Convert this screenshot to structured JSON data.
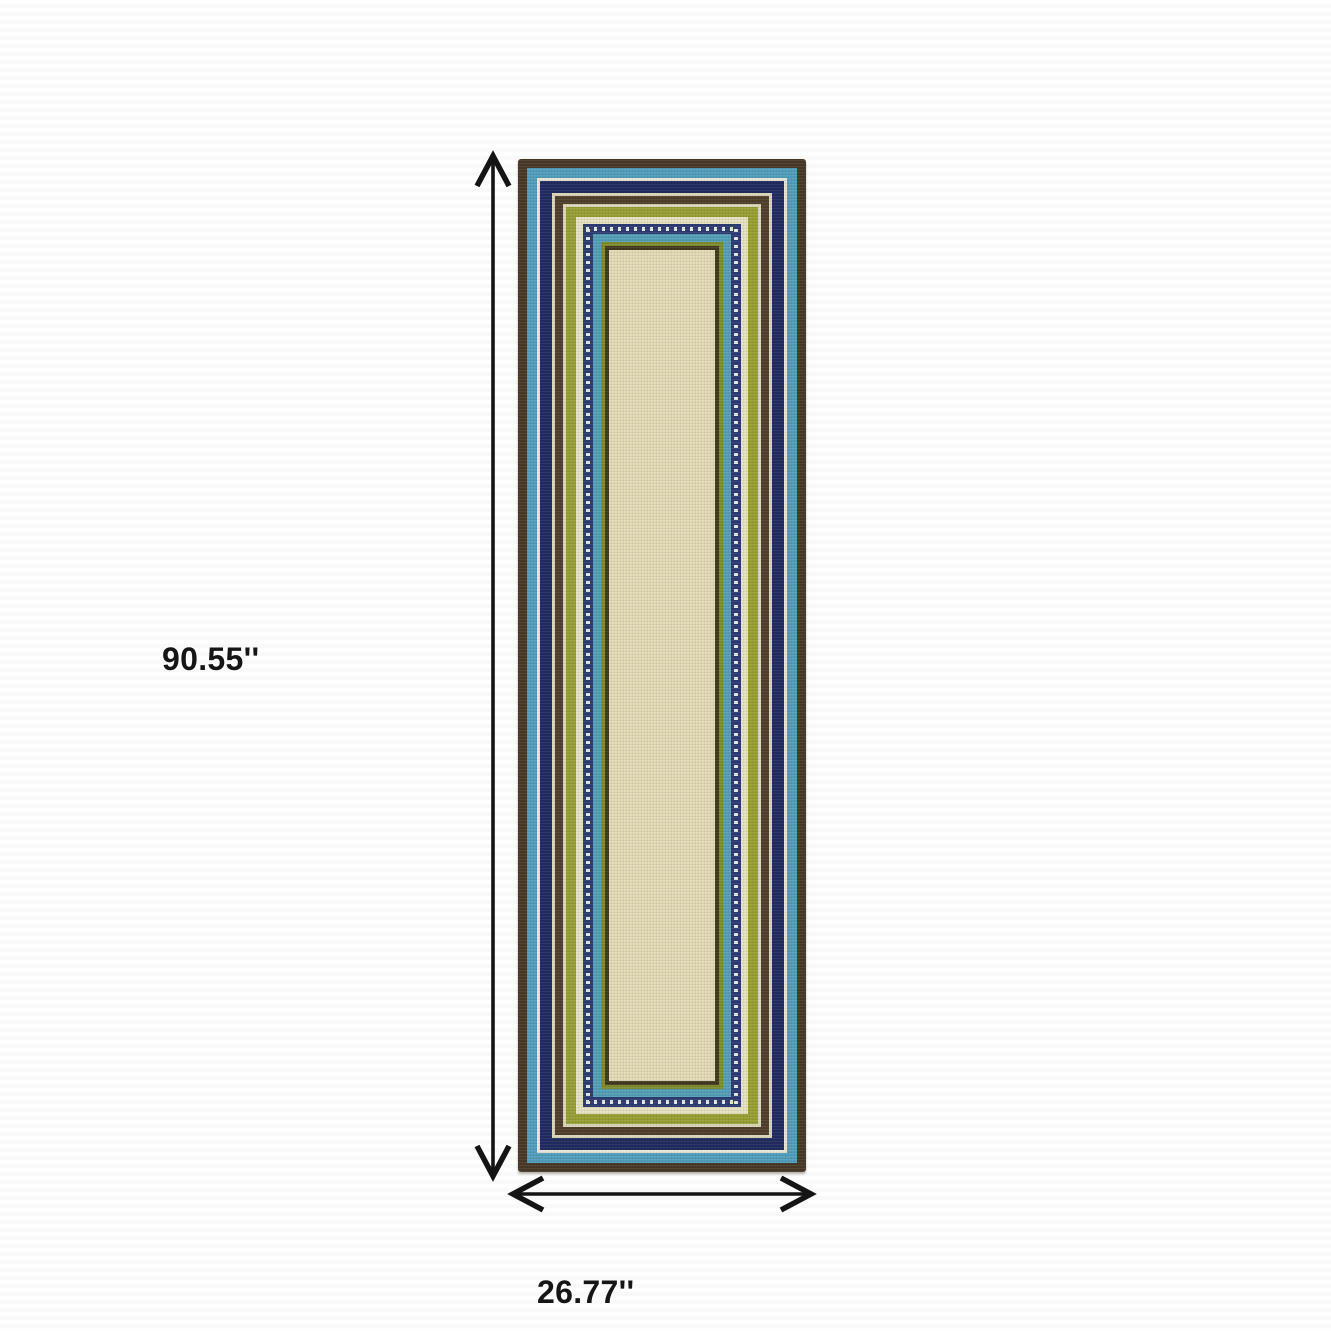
{
  "page": {
    "background_color": "#ffffff",
    "background_stripe_color": "#f8f9f9",
    "annotation_color": "#141414"
  },
  "dimensions": {
    "height_label": "90.55''",
    "width_label": "26.77''"
  },
  "rug": {
    "description": "runner rug with concentric striped borders",
    "center_color": "#e1dab4",
    "stripes": [
      {
        "name": "outer-brown",
        "color": "#483828",
        "width": 9
      },
      {
        "name": "light-blue",
        "color": "#519ebd",
        "width": 10
      },
      {
        "name": "white-line",
        "color": "#e9e7d8",
        "width": 3
      },
      {
        "name": "navy",
        "color": "#1f2b60",
        "width": 12
      },
      {
        "name": "cream-line",
        "color": "#dcd7ba",
        "width": 3
      },
      {
        "name": "mid-brown",
        "color": "#4f3f2a",
        "width": 8
      },
      {
        "name": "cream-line-2",
        "color": "#dcd7ba",
        "width": 3
      },
      {
        "name": "olive-green",
        "color": "#97a034",
        "width": 10
      },
      {
        "name": "pale-cream",
        "color": "#e6e3c3",
        "width": 7
      },
      {
        "name": "navy-dotted",
        "color": "#2b3a72",
        "width": 10,
        "dotted": true,
        "dot_color": "#e8e8db"
      },
      {
        "name": "teal-blue",
        "color": "#549fb7",
        "width": 8
      },
      {
        "name": "olive-thin",
        "color": "#7e8c2e",
        "width": 4
      },
      {
        "name": "brown-thin",
        "color": "#41381f",
        "width": 4
      }
    ]
  }
}
